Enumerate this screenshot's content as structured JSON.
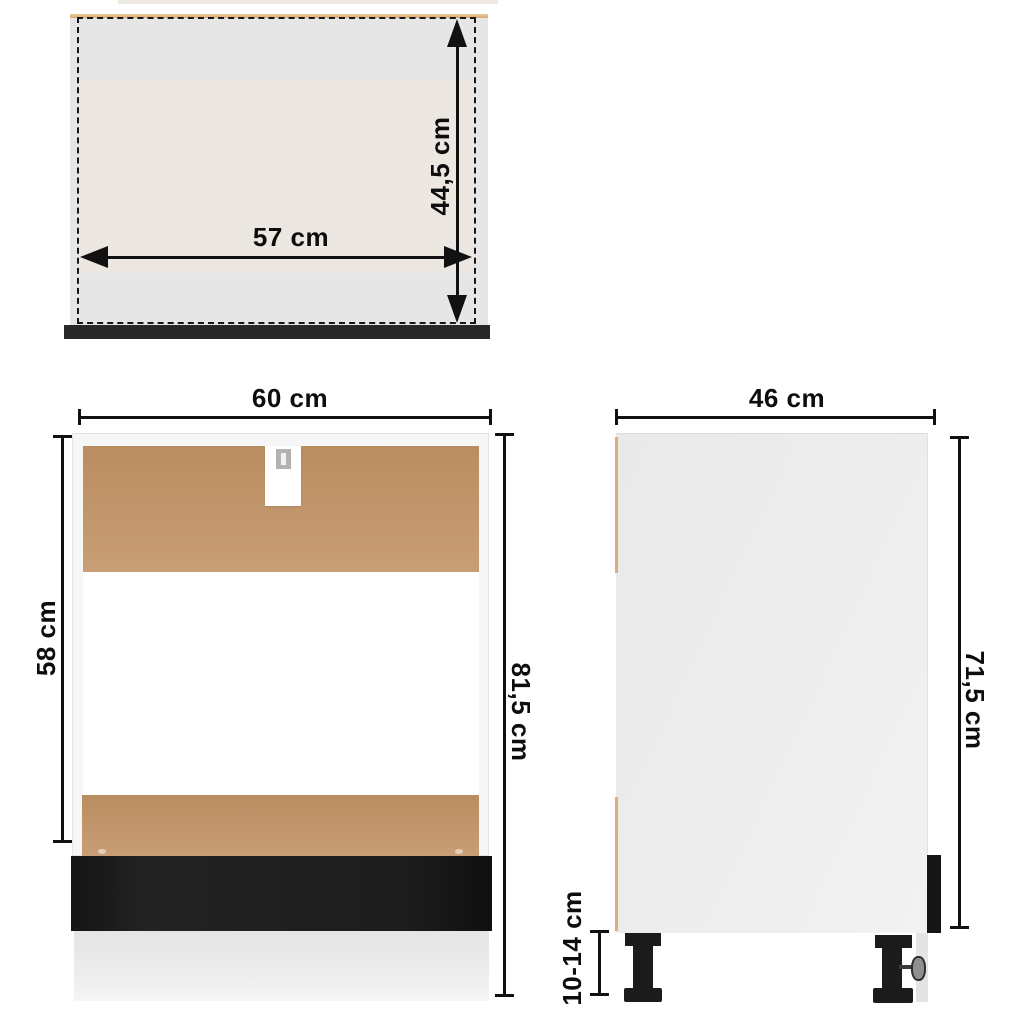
{
  "diagram": {
    "type": "furniture-dimension-diagram",
    "views": {
      "top_view": {
        "description": "top view of cabinet interior (dashed outline)",
        "inner_width": "57 cm",
        "inner_depth": "44,5 cm"
      },
      "front_view": {
        "description": "front view of oven housing cabinet",
        "width": "60 cm",
        "opening_height": "58 cm",
        "total_height": "81,5 cm"
      },
      "side_view": {
        "description": "side view of cabinet",
        "depth": "46 cm",
        "body_height": "71,5 cm",
        "leg_height": "10-14 cm"
      }
    },
    "colors": {
      "dimension_ink": "#111111",
      "hardboard_brown": "#bf9166",
      "wood_edge_tan": "#dcae7c",
      "front_panel_black": "#1b1b1b",
      "cabinet_white": "#f6f6f6",
      "top_view_fill": "#e6e6e6",
      "top_view_inner_fill": "#ece7e1",
      "plinth_gray": "#e9e9e9"
    }
  }
}
